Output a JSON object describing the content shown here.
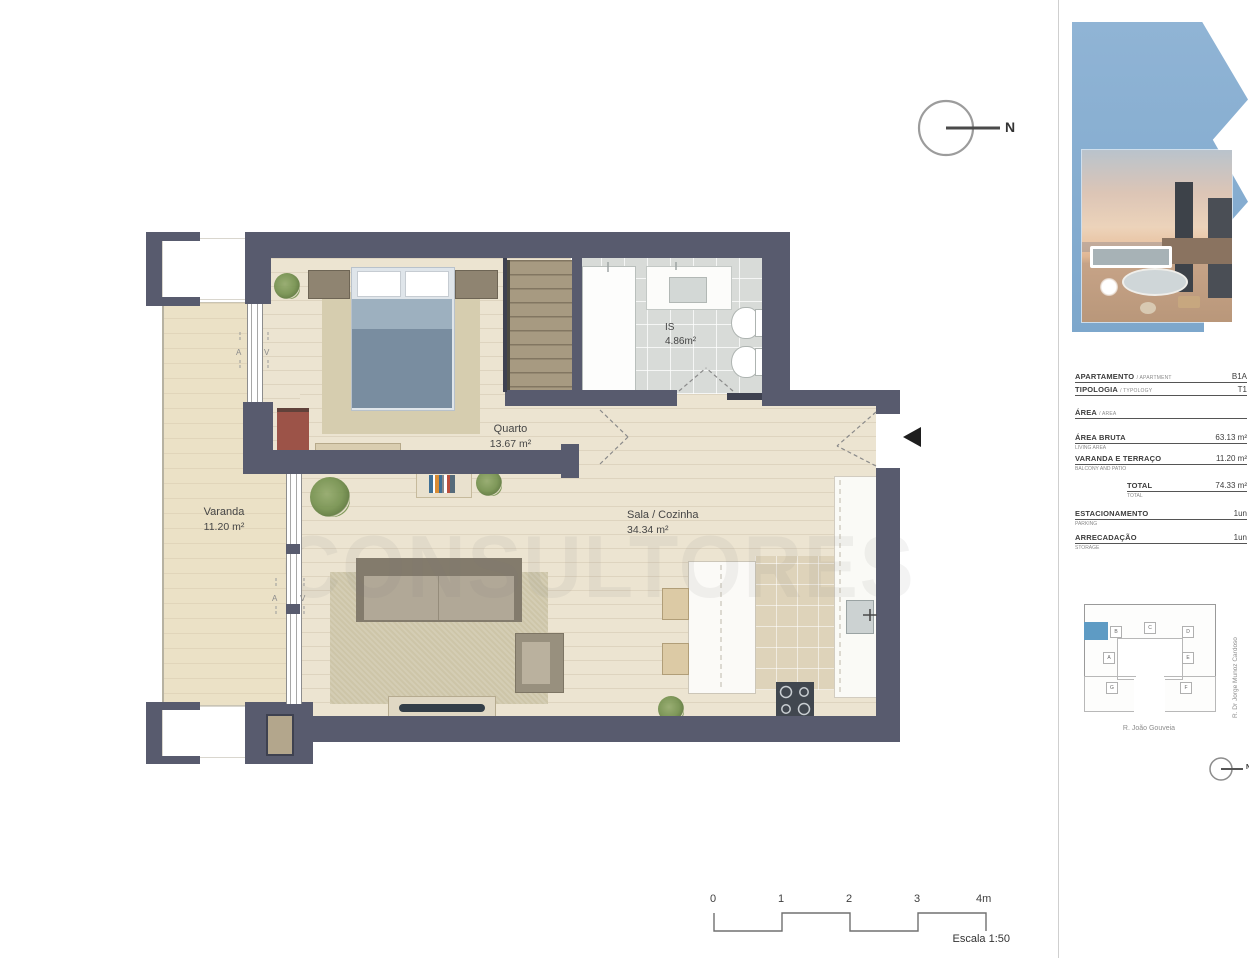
{
  "page": {
    "background": "#ffffff"
  },
  "colors": {
    "wall": "#585b6e",
    "wood_floor": "#ece4d1",
    "balcony_floor": "#ebe1c6",
    "bath_tile": "#d8dbd8",
    "kitchen_tile": "#ded3ba",
    "logo_blue": "#87aed1",
    "site_highlight": "#5e9bc4",
    "bed_spread": "#798da0",
    "living_rug": "#cdc5a8"
  },
  "plan": {
    "watermark": "CONSULTORES",
    "north_label": "N",
    "rooms": [
      {
        "name": "Varanda",
        "area": "11.20 m²"
      },
      {
        "name": "Quarto",
        "area": "13.67 m²"
      },
      {
        "name": "IS",
        "area": "4.86m²"
      },
      {
        "name": "Sala / Cozinha",
        "area": "34.34 m²"
      }
    ],
    "window_marks": [
      "A",
      "V",
      "A",
      "V"
    ],
    "scale_bar": {
      "ticks": [
        "0",
        "1",
        "2",
        "3",
        "4m"
      ],
      "caption": "Escala 1:50"
    }
  },
  "sidebar": {
    "info_table": {
      "rows": [
        {
          "label": "APARTAMENTO",
          "label_sub": "/ APARTMENT",
          "value": "B1A",
          "sub": ""
        },
        {
          "label": "TIPOLOGIA",
          "label_sub": "/ TYPOLOGY",
          "value": "T1",
          "sub": ""
        },
        {
          "label": "ÁREA",
          "label_sub": "/ AREA",
          "value": "",
          "sub": ""
        },
        {
          "label": "ÁREA BRUTA",
          "label_sub": "",
          "value": "63.13 m²",
          "sub": "LIVING AREA"
        },
        {
          "label": "VARANDA E TERRAÇO",
          "label_sub": "",
          "value": "11.20 m²",
          "sub": "BALCONY AND PATIO"
        },
        {
          "label": "TOTAL",
          "label_sub": "",
          "value": "74.33 m²",
          "sub": "TOTAL"
        },
        {
          "label": "ESTACIONAMENTO",
          "label_sub": "",
          "value": "1un",
          "sub": "PARKING"
        },
        {
          "label": "ARRECADAÇÃO",
          "label_sub": "",
          "value": "1un",
          "sub": "STORAGE"
        }
      ]
    },
    "site_plan": {
      "units": [
        "B",
        "C",
        "D",
        "A",
        "E",
        "G",
        "F"
      ],
      "street_bottom": "R. João Gouveia",
      "street_right": "R. Dr Jorge Munoz Cardoso",
      "north_label": "N"
    }
  }
}
